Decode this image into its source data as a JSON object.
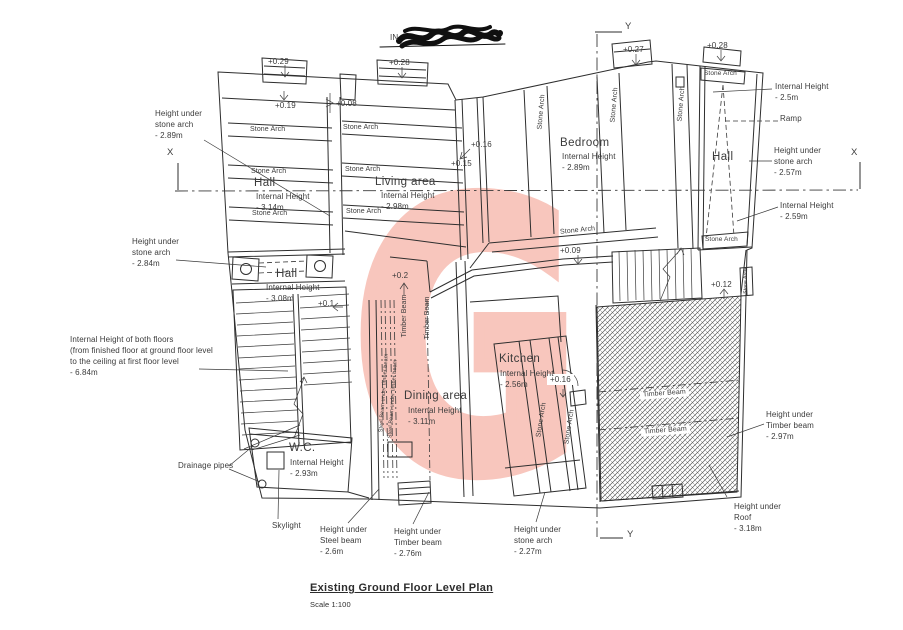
{
  "title": {
    "name": "Existing Ground Floor Level Plan",
    "scale": "Scale 1:100"
  },
  "watermark": {
    "letter": "G",
    "color": "#f8c6bd"
  },
  "axes": {
    "x": "X",
    "y": "Y"
  },
  "redacted_fragment": "IN",
  "labels": {
    "stone_arch": "Stone Arch",
    "timber_beam": "Timber Beam",
    "steel_beam_under_timber_beam": "Steel Beam under timber beam",
    "ramp": "Ramp"
  },
  "rooms": {
    "hall_nw": {
      "name": "Hall",
      "height": "Internal Height\n- 3.14m"
    },
    "living": {
      "name": "Living area",
      "height": "Internal Height\n- 2.98m"
    },
    "bedroom": {
      "name": "Bedroom",
      "height": "Internal Height\n- 2.89m"
    },
    "hall_e": {
      "name": "Hall"
    },
    "hall_mid": {
      "name": "Hall",
      "height": "Internal Height\n- 3.08m"
    },
    "kitchen": {
      "name": "Kitchen",
      "height": "Internal Height\n- 2.56m"
    },
    "dining": {
      "name": "Dining area",
      "height": "Internal Height\n- 3.11m"
    },
    "wc": {
      "name": "W.C.",
      "height": "Internal Height\n- 2.93m"
    }
  },
  "levels": {
    "a": "+0.29",
    "b": "+0.19",
    "c": "+0.08",
    "d": "+0.28",
    "e": "+0.27",
    "f": "+0.28",
    "g": "+0.16",
    "h": "+0.15",
    "i": "+0.09",
    "j": "+0.2",
    "k": "+0.1",
    "l": "+0.16",
    "m": "+0.12"
  },
  "annotations": {
    "arch_289": "Height under\nstone arch\n- 2.89m",
    "arch_284": "Height under\nstone arch\n- 2.84m",
    "both_floors": "Internal Height of both floors\n(from finished floor at ground floor level\nto the ceiling at first floor level\n- 6.84m",
    "drainage": "Drainage pipes",
    "skylight": "Skylight",
    "steel_26": "Height under\nSteel beam\n- 2.6m",
    "timber_276": "Height under\nTimber beam\n- 2.76m",
    "arch_227": "Height under\nstone arch\n- 2.27m",
    "ih_25": "Internal Height\n- 2.5m",
    "arch_257": "Height under\nstone arch\n- 2.57m",
    "ih_259": "Internal Height\n- 2.59m",
    "timber_297": "Height under\nTimber beam\n- 2.97m",
    "roof_318": "Height under\nRoof\n- 3.18m"
  }
}
